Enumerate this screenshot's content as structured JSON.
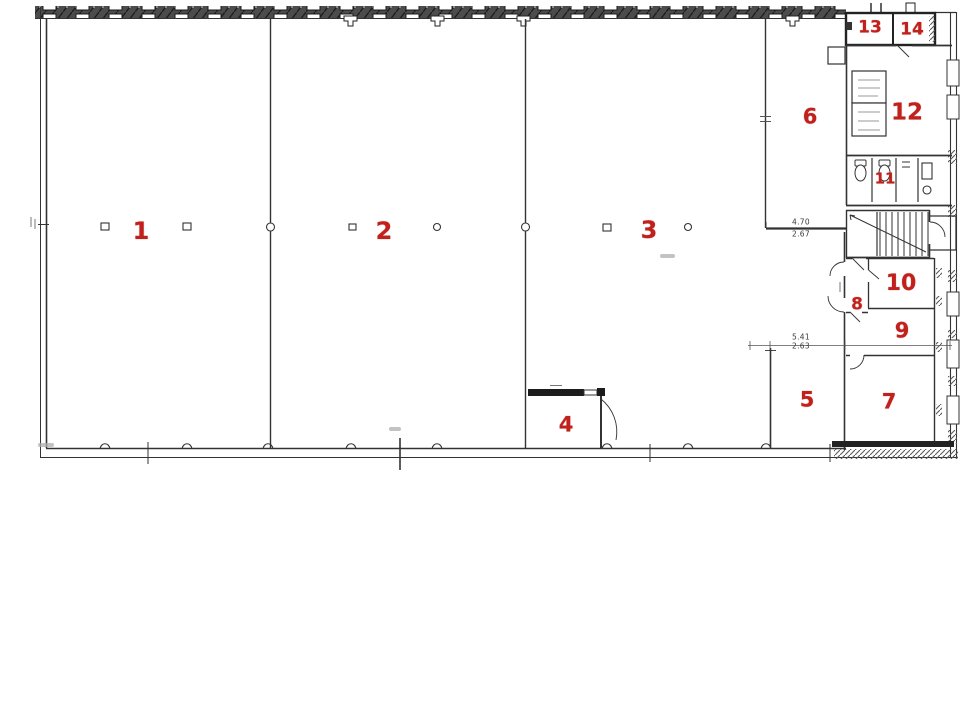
{
  "plan": {
    "type": "building-floor-plan",
    "rooms": [
      {
        "number": "1"
      },
      {
        "number": "2"
      },
      {
        "number": "3"
      },
      {
        "number": "4"
      },
      {
        "number": "5"
      },
      {
        "number": "6"
      },
      {
        "number": "7"
      },
      {
        "number": "8"
      },
      {
        "number": "9"
      },
      {
        "number": "10"
      },
      {
        "number": "11"
      },
      {
        "number": "12"
      },
      {
        "number": "13"
      },
      {
        "number": "14"
      }
    ],
    "annotations": {
      "corridor_dim_top": "4.70",
      "corridor_dim_bottom": "2.67",
      "room5_dim_top": "5.41",
      "room5_dim_bottom": "2.63"
    },
    "colors": {
      "label_red": "#c2201a",
      "ink": "#333333",
      "paper": "#ffffff"
    }
  }
}
